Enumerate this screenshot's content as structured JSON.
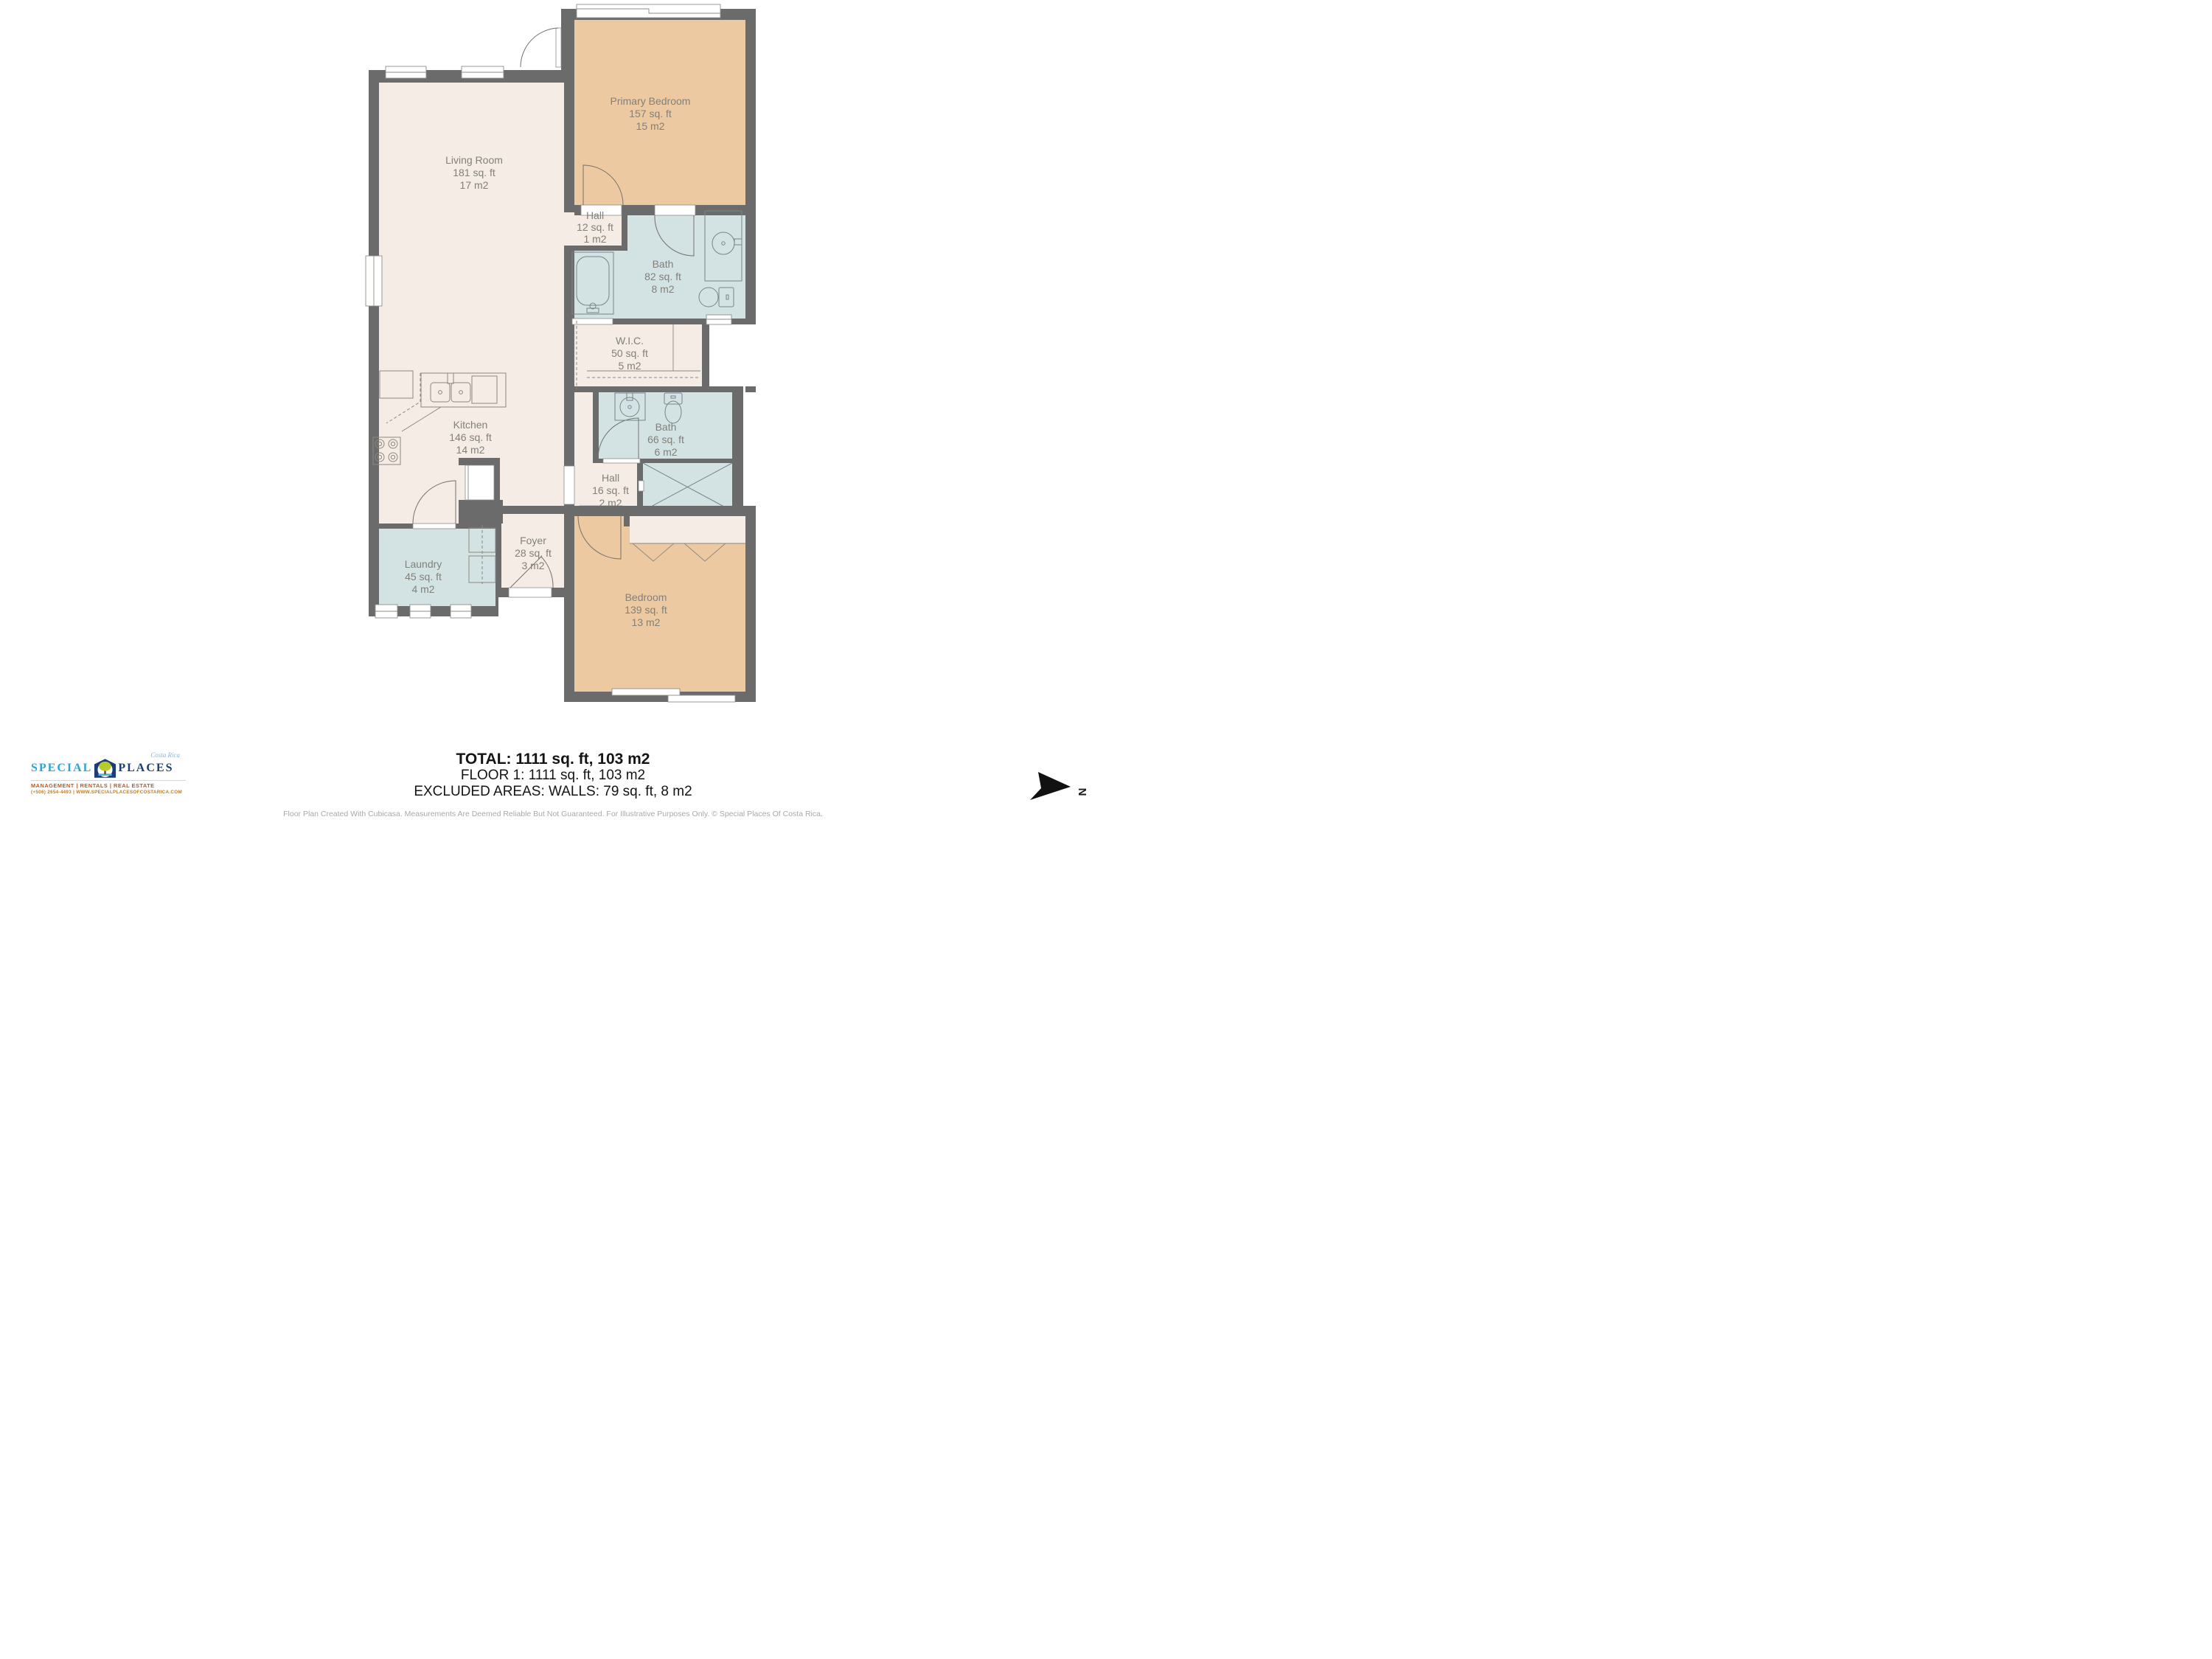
{
  "rooms": [
    {
      "name": "Living Room",
      "area_ft": "181 sq. ft",
      "area_m2": "17 m2"
    },
    {
      "name": "Primary Bedroom",
      "area_ft": "157 sq. ft",
      "area_m2": "15 m2"
    },
    {
      "name": "Hall",
      "area_ft": "12 sq. ft",
      "area_m2": "1 m2"
    },
    {
      "name": "Bath",
      "area_ft": "82 sq. ft",
      "area_m2": "8 m2"
    },
    {
      "name": "W.I.C.",
      "area_ft": "50 sq. ft",
      "area_m2": "5 m2"
    },
    {
      "name": "Bath",
      "area_ft": "66 sq. ft",
      "area_m2": "6 m2"
    },
    {
      "name": "Hall",
      "area_ft": "16 sq. ft",
      "area_m2": "2 m2"
    },
    {
      "name": "Foyer",
      "area_ft": "28 sq. ft",
      "area_m2": "3 m2"
    },
    {
      "name": "Laundry",
      "area_ft": "45 sq. ft",
      "area_m2": "4 m2"
    },
    {
      "name": "Kitchen",
      "area_ft": "146 sq. ft",
      "area_m2": "14 m2"
    },
    {
      "name": "Bedroom",
      "area_ft": "139 sq. ft",
      "area_m2": "13 m2"
    }
  ],
  "summary": {
    "total": "TOTAL: 1111 sq. ft, 103 m2",
    "floor": "FLOOR 1: 1111 sq. ft, 103 m2",
    "excluded": "EXCLUDED AREAS: WALLS: 79 sq. ft, 8 m2"
  },
  "footer": "Floor Plan Created With Cubicasa. Measurements Are Deemed Reliable But Not Guaranteed. For Illustrative Purposes Only. © Special Places Of Costa Rica.",
  "logo": {
    "name_left": "SPECIAL",
    "name_right": "PLACES",
    "region": "Costa Rica",
    "tagline": "MANAGEMENT | RENTALS | REAL ESTATE",
    "contact": "(+506) 2654-4493 | WWW.SPECIALPLACESOFCOSTARICA.COM"
  },
  "compass": {
    "label": "N"
  },
  "colors": {
    "wall": "#6b6b6b",
    "floor_cream": "#f4ece5",
    "floor_peach": "#ecc9a0",
    "floor_bath": "#d3e3e3",
    "label_text": "#82807a",
    "brand_blue": "#2ea4d4",
    "brand_navy": "#1d3e74",
    "brand_orange": "#c2581f",
    "brand_gold": "#bf7d22"
  }
}
